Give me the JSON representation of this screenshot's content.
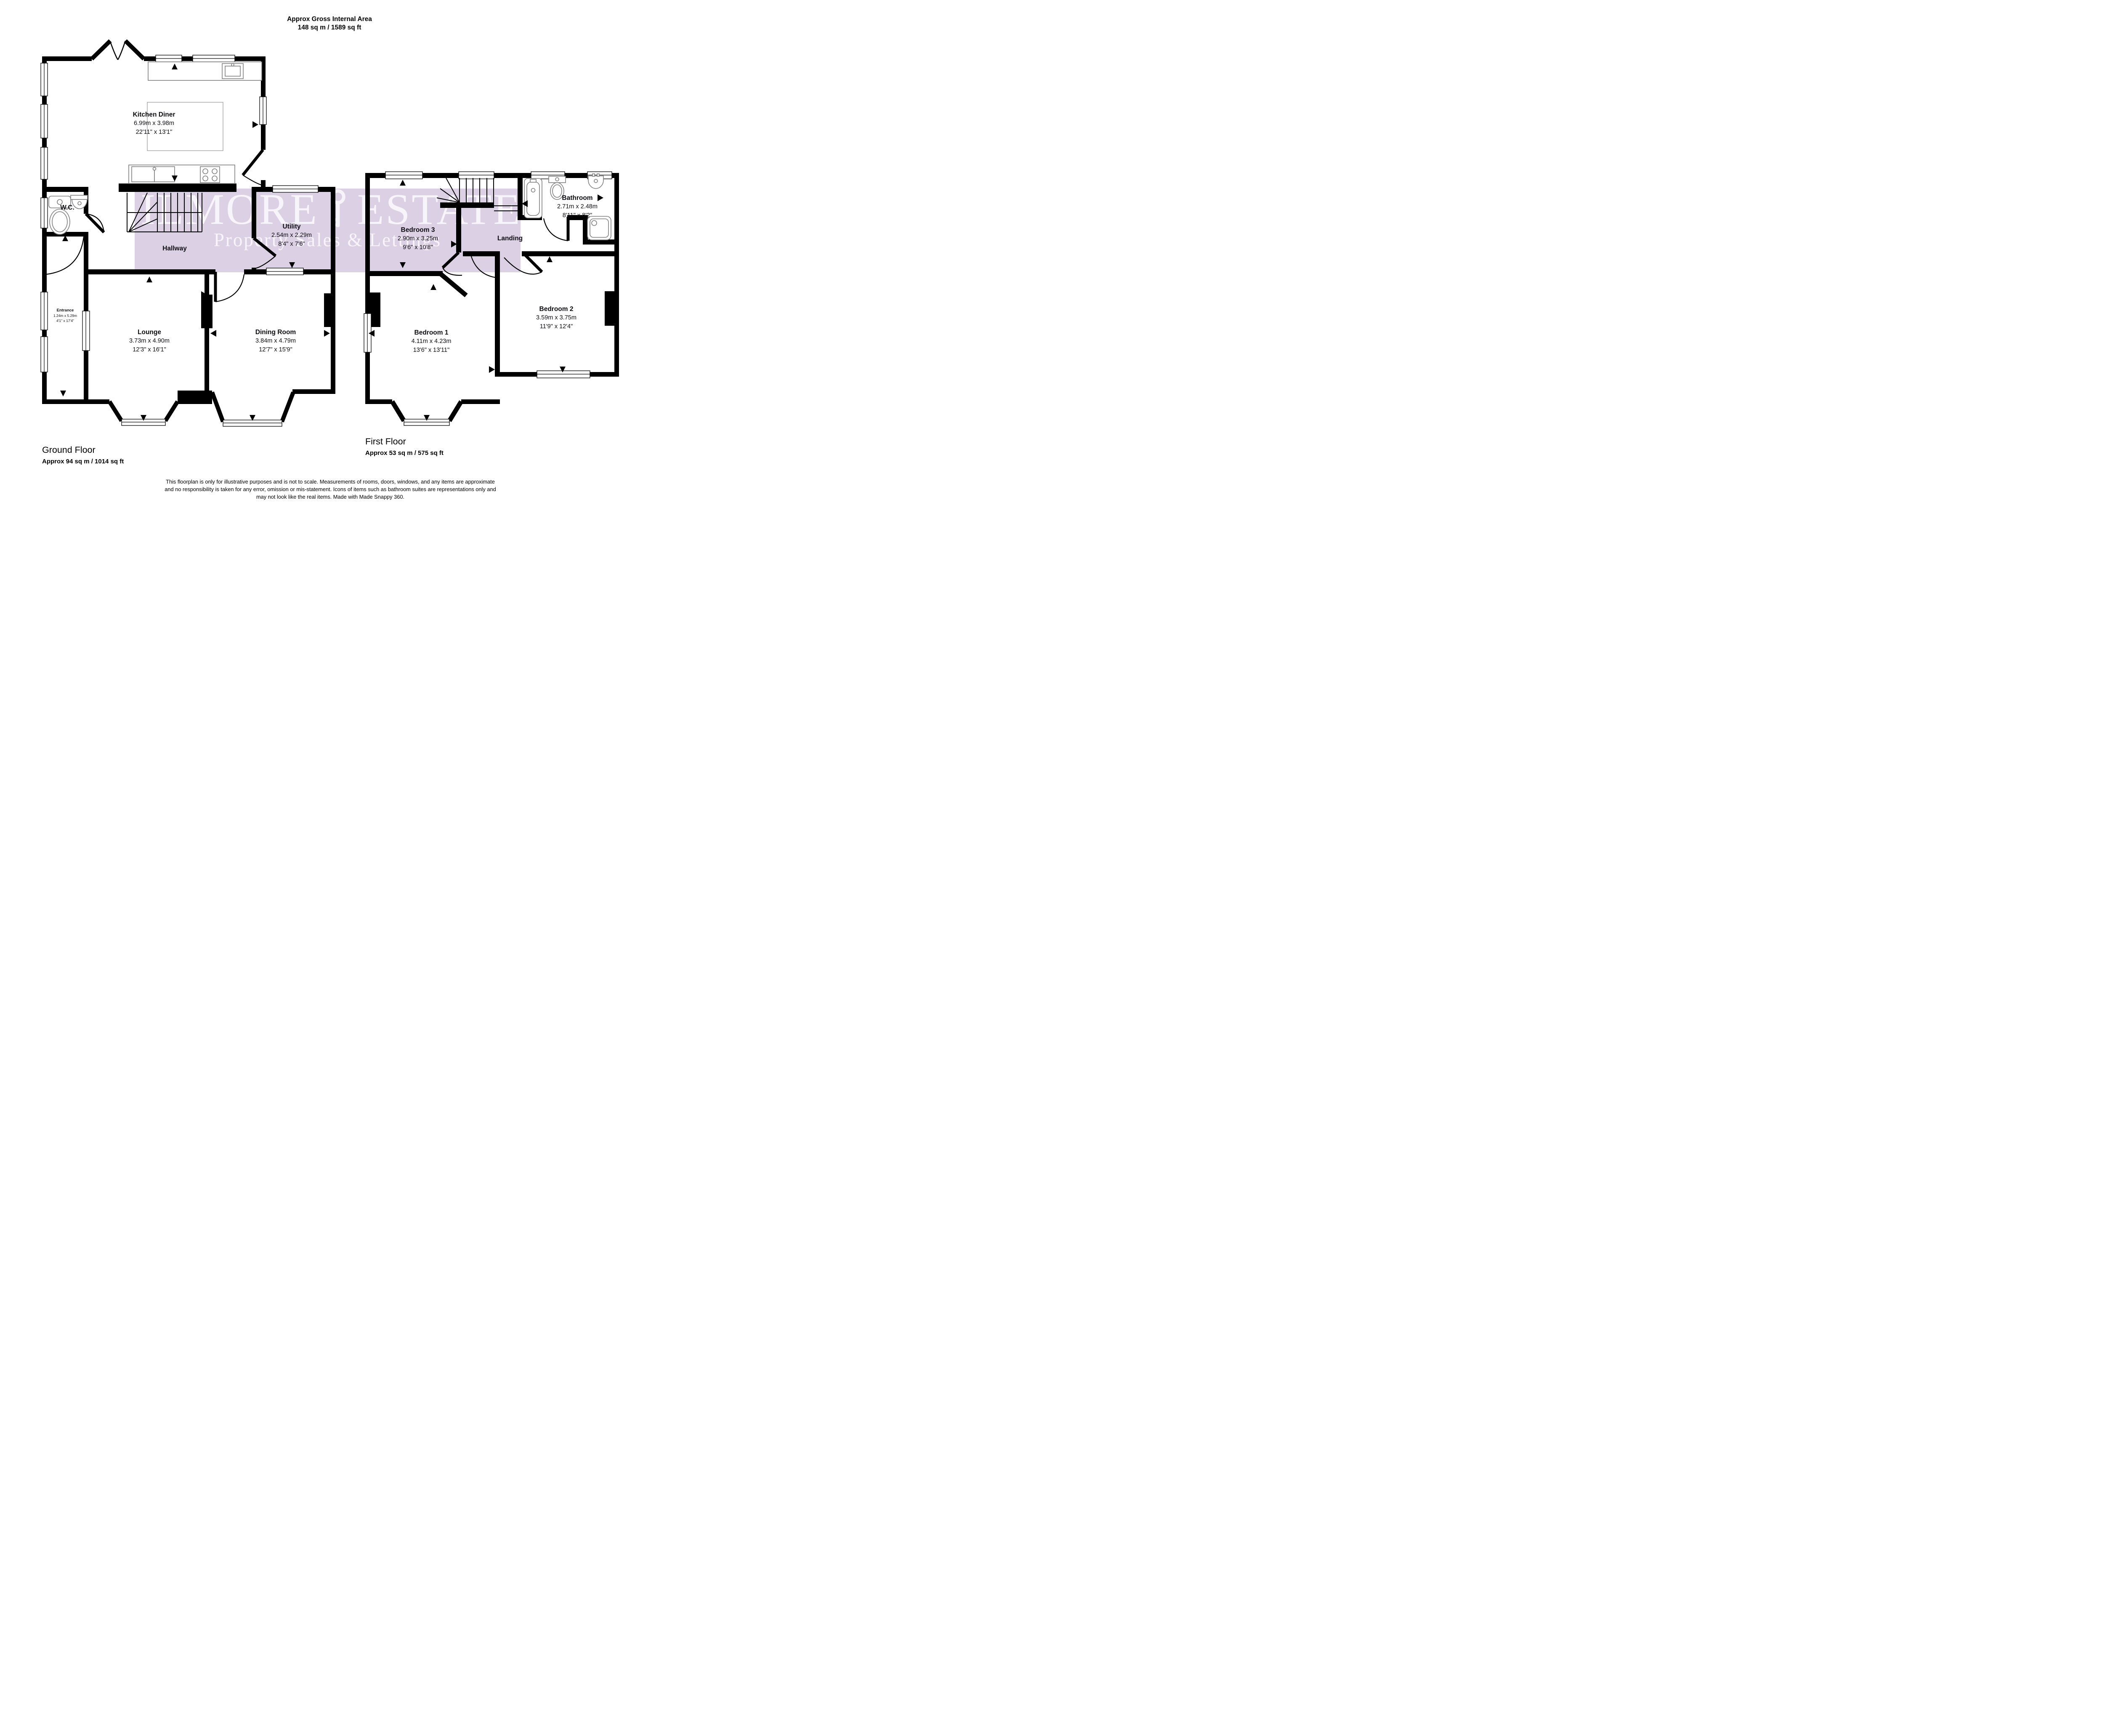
{
  "title": {
    "line1": "Approx Gross Internal Area",
    "line2": "148 sq m / 1589 sq ft"
  },
  "watermark": {
    "brand_left": "GILMORE",
    "brand_right": "ESTATES",
    "tagline": "Property Sales & Lettings",
    "band_color": "#dcd0e4",
    "text_color": "#ffffff"
  },
  "ground_floor": {
    "name": "Ground Floor",
    "area": "Approx 94 sq m / 1014 sq ft",
    "rooms": {
      "kitchen": {
        "name": "Kitchen Diner",
        "metric": "6.99m x 3.98m",
        "imperial": "22'11\" x 13'1\""
      },
      "utility": {
        "name": "Utility",
        "metric": "2.54m x 2.29m",
        "imperial": "8'4\" x 7'6\""
      },
      "wc": {
        "name": "W.C."
      },
      "hallway": {
        "name": "Hallway"
      },
      "entrance": {
        "name": "Entrance",
        "metric": "1.24m x 5.29m",
        "imperial": "4'1\" x 17'4\""
      },
      "lounge": {
        "name": "Lounge",
        "metric": "3.73m x 4.90m",
        "imperial": "12'3\" x 16'1\""
      },
      "dining": {
        "name": "Dining Room",
        "metric": "3.84m x 4.79m",
        "imperial": "12'7\" x 15'9\""
      }
    }
  },
  "first_floor": {
    "name": "First Floor",
    "area": "Approx 53 sq m / 575 sq ft",
    "rooms": {
      "bedroom3": {
        "name": "Bedroom 3",
        "metric": "2.90m x 3.25m",
        "imperial": "9'6\" x 10'8\""
      },
      "bathroom": {
        "name": "Bathroom",
        "metric": "2.71m x 2.48m",
        "imperial": "8'11\" x 8'2\""
      },
      "landing": {
        "name": "Landing"
      },
      "bedroom1": {
        "name": "Bedroom 1",
        "metric": "4.11m x 4.23m",
        "imperial": "13'6\" x 13'11\""
      },
      "bedroom2": {
        "name": "Bedroom 2",
        "metric": "3.59m x 3.75m",
        "imperial": "11'9\" x 12'4\""
      }
    }
  },
  "disclaimer": {
    "line1": "This floorplan is only for illustrative purposes and is not to scale. Measurements of rooms, doors, windows, and any items are approximate",
    "line2": "and no responsibility is taken for any error, omission or mis-statement. Icons of items such as bathroom suites are representations only and",
    "line3": "may not look like the real items. Made with Made Snappy 360."
  }
}
